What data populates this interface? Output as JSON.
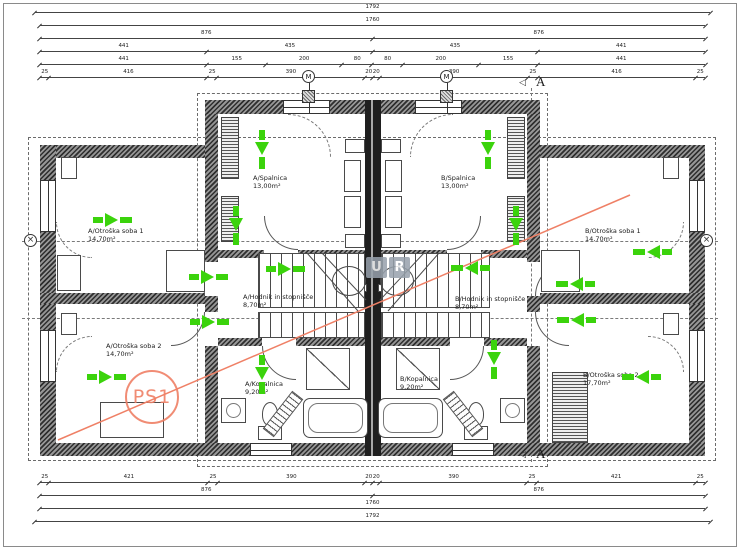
{
  "drawing": {
    "rooms": [
      {
        "name": "A/Spalnica",
        "area": "13,00m²",
        "x": 253,
        "y": 175
      },
      {
        "name": "B/Spalnica",
        "area": "13,00m²",
        "x": 441,
        "y": 175
      },
      {
        "name": "A/Otroška soba 1",
        "area": "14,70m²",
        "x": 88,
        "y": 228
      },
      {
        "name": "B/Otroška soba 1",
        "area": "14,70m²",
        "x": 585,
        "y": 228
      },
      {
        "name": "A/Otroška soba 2",
        "area": "14,70m²",
        "x": 106,
        "y": 343
      },
      {
        "name": "B/Otroška soba 2",
        "area": "17,70m²",
        "x": 583,
        "y": 372
      },
      {
        "name": "A/Hodnik in stopnišče",
        "area": "8,70m²",
        "x": 243,
        "y": 294
      },
      {
        "name": "B/Hodnik in stopnišče",
        "area": "8,70m²",
        "x": 455,
        "y": 296
      },
      {
        "name": "A/Kopalnica",
        "area": "9,20m²",
        "x": 245,
        "y": 381
      },
      {
        "name": "B/Kopalnica",
        "area": "9,20m²",
        "x": 400,
        "y": 376
      }
    ],
    "dimensions": {
      "top": [
        [
          1792
        ],
        [
          1760
        ],
        [
          876,
          876
        ],
        [
          441,
          435,
          435,
          441
        ],
        [
          441,
          155,
          200,
          80,
          80,
          200,
          155,
          441
        ],
        [
          25,
          416,
          25,
          390,
          20,
          20,
          390,
          25,
          416,
          25
        ]
      ],
      "bottom": [
        [
          25,
          421,
          25,
          390,
          20,
          20,
          390,
          25,
          421,
          25
        ],
        [
          876,
          876
        ],
        [
          1760
        ],
        [
          1792
        ]
      ]
    },
    "arrows": [
      {
        "x": 113,
        "y": 220,
        "dir": "right"
      },
      {
        "x": 107,
        "y": 377,
        "dir": "right"
      },
      {
        "x": 652,
        "y": 252,
        "dir": "left"
      },
      {
        "x": 641,
        "y": 377,
        "dir": "left"
      },
      {
        "x": 262,
        "y": 150,
        "dir": "down"
      },
      {
        "x": 488,
        "y": 150,
        "dir": "down"
      },
      {
        "x": 236,
        "y": 226,
        "dir": "down"
      },
      {
        "x": 516,
        "y": 226,
        "dir": "down"
      },
      {
        "x": 209,
        "y": 277,
        "dir": "right"
      },
      {
        "x": 286,
        "y": 269,
        "dir": "right"
      },
      {
        "x": 470,
        "y": 268,
        "dir": "left"
      },
      {
        "x": 575,
        "y": 284,
        "dir": "left"
      },
      {
        "x": 210,
        "y": 322,
        "dir": "right"
      },
      {
        "x": 576,
        "y": 320,
        "dir": "left"
      },
      {
        "x": 262,
        "y": 375,
        "dir": "down"
      },
      {
        "x": 494,
        "y": 360,
        "dir": "down"
      }
    ],
    "annotations": {
      "ps1": "PS1",
      "section_letter": "A",
      "vent_letter": "M",
      "watermark_letters": [
        "U",
        "R"
      ],
      "axis_marker_glyph": "×"
    },
    "colors": {
      "arrow_green": "#3bd30c",
      "marker_orange": "#ef8066",
      "wall_gray": "#2f2f2f",
      "watermark_gray": "#97a1ac"
    },
    "icons": {
      "direction_arrow": "green-breakthrough-arrow-icon",
      "axis_marker": "circle-x-icon",
      "vent_symbol": "circled-letter-icon",
      "section_arrow": "open-triangle-icon"
    }
  }
}
